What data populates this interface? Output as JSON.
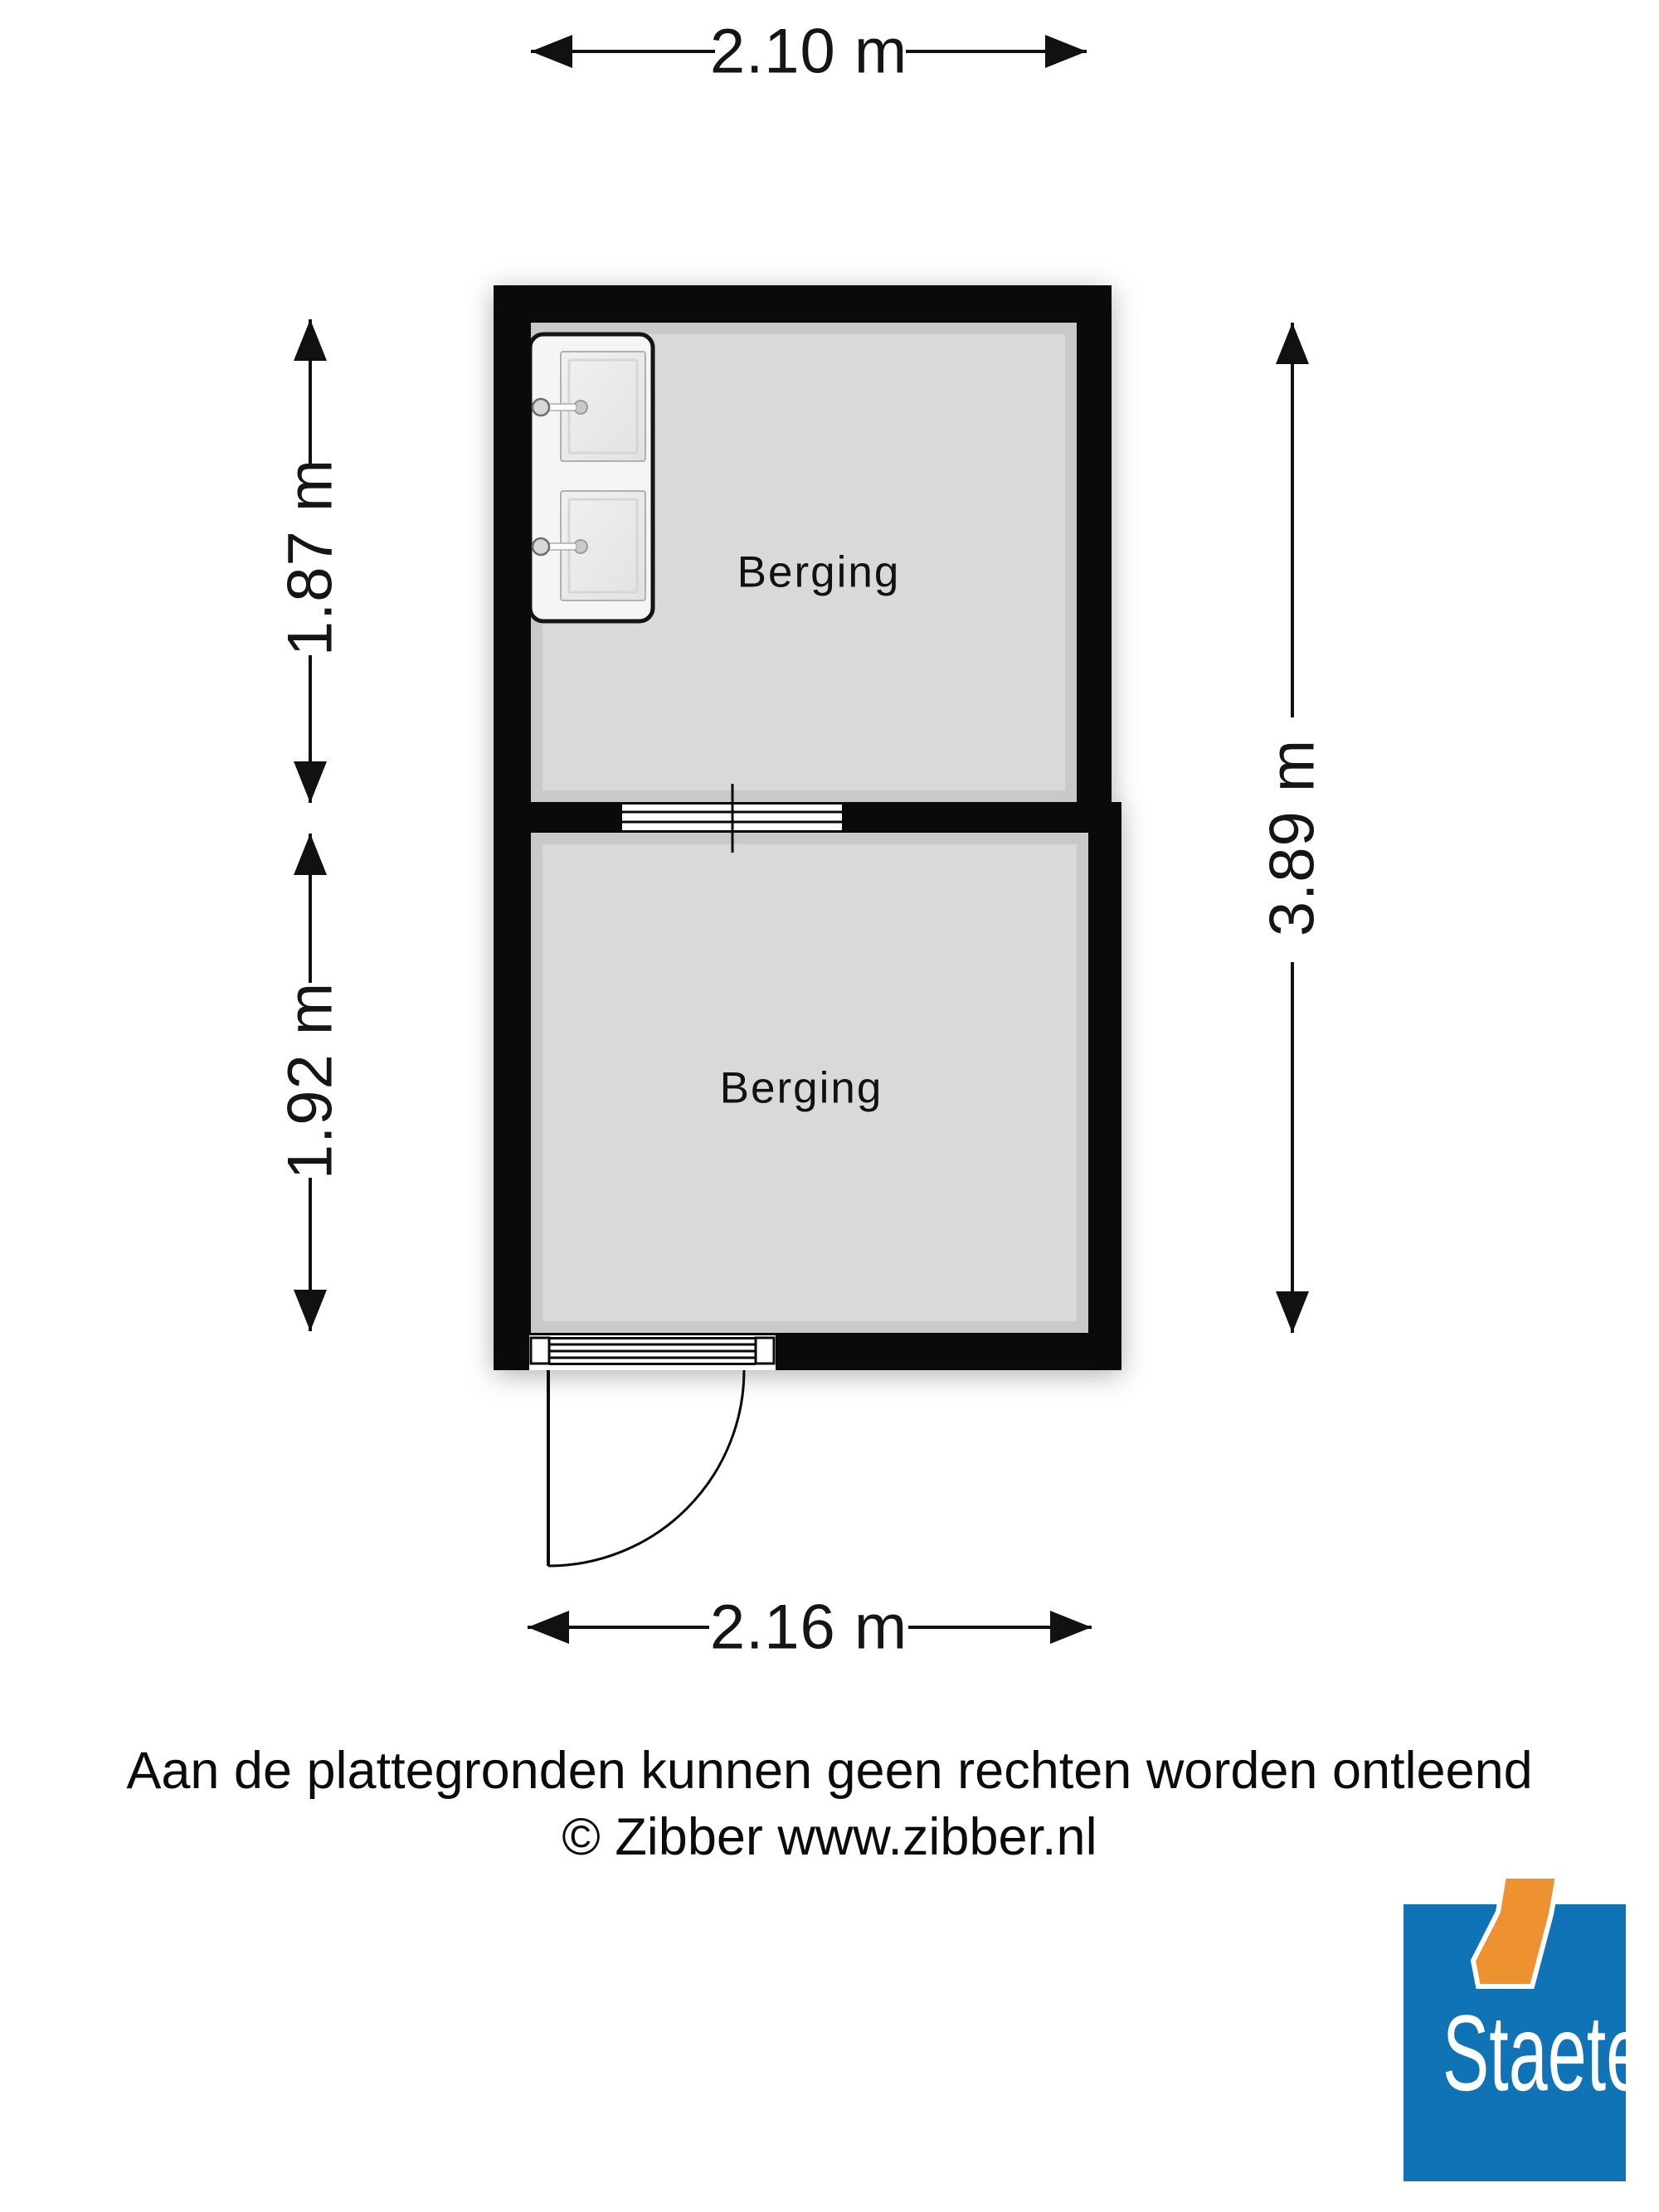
{
  "plan": {
    "rooms": [
      {
        "label": "Berging"
      },
      {
        "label": "Berging"
      }
    ],
    "dimensions": {
      "top": "2.10 m",
      "left_upper": "1.87 m",
      "left_lower": "1.92 m",
      "right": "3.89 m",
      "bottom": "2.16 m"
    },
    "features": {
      "fixture": "double-sink-unit",
      "window": "window-in-dividing-wall",
      "door": "hinged-door-swing-outward"
    },
    "colors": {
      "wall": "#0a0a0a",
      "floor": "#d9d9d9"
    }
  },
  "footer": {
    "disclaimer": "Aan de plattegronden kunnen geen rechten worden ontleend",
    "copyright": "© Zibber www.zibber.nl"
  },
  "logo": {
    "text": "Staete",
    "colors": {
      "blue": "#0f73b5",
      "orange": "#ee9231"
    }
  }
}
